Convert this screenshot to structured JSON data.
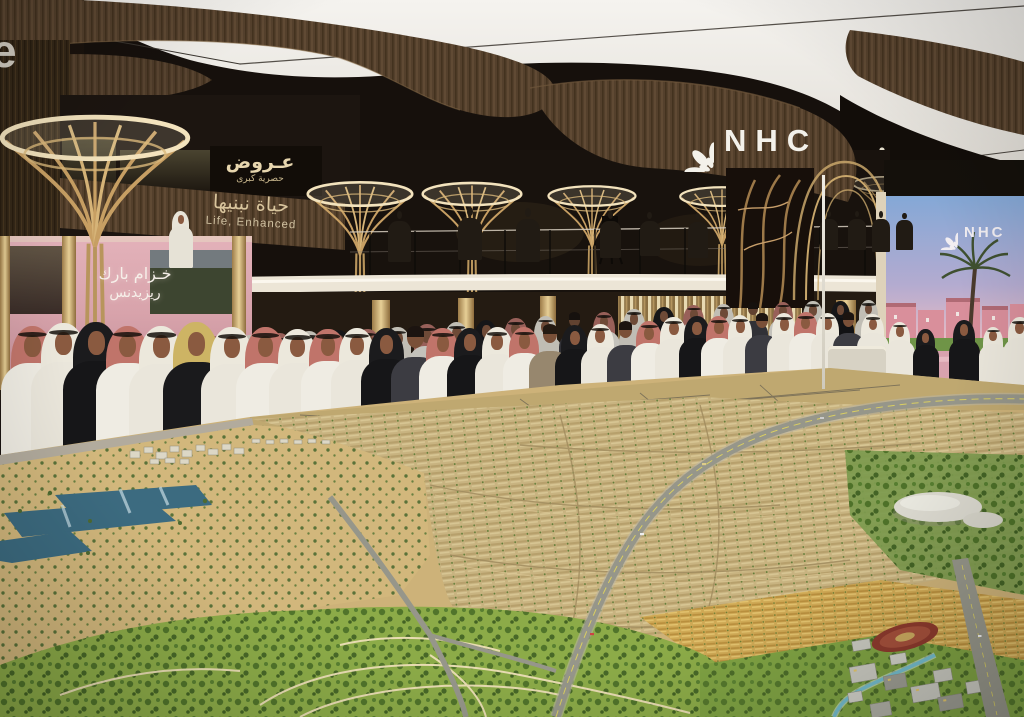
{
  "scene": {
    "description": "Crowded real-estate exhibition stand of NHC with visitors in Saudi traditional dress viewing a giant illuminated scale model of a desert city masterplan",
    "elements": [
      "white luminous ceiling with wavy wooden canopies",
      "golden palm-shaped light columns",
      "mezzanine with camera crews",
      "pink lit booth",
      "large LED screen with community render",
      "huge city masterplan model with desert, lakes, housing rows, park, highway and stadium"
    ]
  },
  "branding": {
    "logo_text": "NHC",
    "logo_mark": "leaf-rosette"
  },
  "signage": {
    "fascia_arabic": "حياة نبنيها",
    "fascia_english": "Life, Enhanced",
    "offers_line1": "عـروض",
    "offers_line2": "حصرية كبرى",
    "booth_arabic_line1": "خـزام بارك",
    "booth_arabic_line2": "ريزيدنس",
    "left_edge_partial": "e"
  },
  "led_screen": {
    "logo_text": "NHC",
    "content": "residential community render: blue-pink sky, pink villas, palm trees, green lawns, pink walkways"
  },
  "colors": {
    "ceilingWhite": "#f2f0ea",
    "wood": "#5a4430",
    "woodDark": "#2e2318",
    "gold": "#c9a76b",
    "glow": "#f7ead0",
    "pinkBooth": "#d8a3ab",
    "screenSky": "#84a8d6",
    "screenPink": "#e8c2c0",
    "screenBuilding": "#d98f9b",
    "sand": "#d2b77c",
    "modelBeige": "#c8b380",
    "parkGreen": "#8cab48",
    "treeGreen": "#4e7129",
    "water": "#3c6b80",
    "road": "#96968a",
    "laneYellow": "#d9ce62",
    "stadiumRed": "#8c3a2d",
    "whiteBldg": "#dbd9cf",
    "beamWhite": "#ece5d6"
  },
  "crowd": {
    "fields": [
      "x",
      "baseY",
      "h",
      "type",
      "backRow"
    ],
    "types": {
      "thobeRed": {
        "kind": "g",
        "drape": "#c0746a",
        "body": "#efece3",
        "agal": true
      },
      "thobeWhite": {
        "kind": "g",
        "drape": "#ece8dc",
        "body": "#eae6db",
        "agal": true
      },
      "abaya": {
        "kind": "g",
        "drape": "#1b1b1d",
        "body": "#161618",
        "agal": false
      },
      "abayaY": {
        "kind": "g",
        "drape": "#cdb464",
        "body": "#1a1a1c",
        "agal": false
      },
      "thobeWhiteS": {
        "kind": "g",
        "drape": "#e8e4d8",
        "body": "#e6e2d6",
        "agal": false
      },
      "casualDark": {
        "kind": "casual",
        "body": "#3c3c42",
        "hair": "#1c1410"
      },
      "casualTan": {
        "kind": "casual",
        "body": "#97876e",
        "hair": "#241a12"
      },
      "silhouette": {
        "kind": "sil",
        "body": "#211b14"
      }
    },
    "people": [
      [
        168,
        268,
        60,
        "thobeWhiteS",
        0
      ],
      [
        388,
        262,
        52,
        "silhouette",
        0
      ],
      [
        458,
        260,
        54,
        "silhouette",
        0
      ],
      [
        516,
        262,
        55,
        "silhouette",
        0
      ],
      [
        600,
        258,
        48,
        "silhouette",
        0
      ],
      [
        640,
        256,
        45,
        "silhouette",
        0
      ],
      [
        688,
        258,
        46,
        "silhouette",
        0
      ],
      [
        820,
        250,
        40,
        "silhouette",
        0
      ],
      [
        848,
        250,
        40,
        "silhouette",
        0
      ],
      [
        872,
        252,
        42,
        "silhouette",
        0
      ],
      [
        896,
        250,
        38,
        "silhouette",
        0
      ],
      [
        12,
        440,
        115,
        "thobeWhite",
        1
      ],
      [
        40,
        442,
        112,
        "thobeRed",
        1
      ],
      [
        70,
        444,
        110,
        "thobeWhite",
        1
      ],
      [
        100,
        440,
        108,
        "abaya",
        1
      ],
      [
        130,
        438,
        108,
        "thobeRed",
        1
      ],
      [
        160,
        440,
        110,
        "thobeWhite",
        1
      ],
      [
        195,
        436,
        105,
        "thobeRed",
        1
      ],
      [
        228,
        432,
        102,
        "thobeWhite",
        1
      ],
      [
        258,
        428,
        100,
        "thobeRed",
        1
      ],
      [
        288,
        424,
        98,
        "thobeWhite",
        1
      ],
      [
        318,
        420,
        95,
        "abaya",
        1
      ],
      [
        348,
        416,
        92,
        "thobeRed",
        1
      ],
      [
        378,
        412,
        90,
        "thobeWhite",
        1
      ],
      [
        408,
        408,
        88,
        "thobeRed",
        1
      ],
      [
        438,
        404,
        86,
        "thobeWhite",
        1
      ],
      [
        468,
        400,
        84,
        "abaya",
        1
      ],
      [
        498,
        396,
        82,
        "thobeRed",
        1
      ],
      [
        528,
        392,
        80,
        "thobeWhite",
        1
      ],
      [
        558,
        388,
        78,
        "casualDark",
        1
      ],
      [
        588,
        384,
        76,
        "thobeRed",
        1
      ],
      [
        618,
        380,
        75,
        "thobeWhite",
        1
      ],
      [
        648,
        377,
        74,
        "abaya",
        1
      ],
      [
        678,
        374,
        73,
        "thobeRed",
        1
      ],
      [
        708,
        372,
        72,
        "thobeWhite",
        1
      ],
      [
        738,
        370,
        70,
        "casualDark",
        1
      ],
      [
        768,
        368,
        70,
        "thobeRed",
        1
      ],
      [
        798,
        366,
        68,
        "thobeWhite",
        1
      ],
      [
        826,
        364,
        66,
        "abaya",
        1
      ],
      [
        854,
        363,
        66,
        "thobeWhite",
        1
      ],
      [
        0,
        468,
        150,
        "thobeRed",
        0
      ],
      [
        30,
        470,
        155,
        "thobeWhite",
        0
      ],
      [
        62,
        472,
        158,
        "abaya",
        0
      ],
      [
        95,
        468,
        150,
        "thobeRed",
        0
      ],
      [
        128,
        470,
        152,
        "thobeWhite",
        0
      ],
      [
        162,
        474,
        160,
        "abayaY",
        0
      ],
      [
        200,
        468,
        148,
        "thobeWhite",
        0
      ],
      [
        235,
        462,
        142,
        "thobeRed",
        0
      ],
      [
        268,
        458,
        136,
        "thobeWhite",
        0
      ],
      [
        300,
        452,
        130,
        "thobeRed",
        0
      ],
      [
        330,
        448,
        126,
        "thobeWhite",
        0
      ],
      [
        360,
        444,
        122,
        "abaya",
        0
      ],
      [
        390,
        440,
        118,
        "casualDark",
        0
      ],
      [
        418,
        436,
        114,
        "thobeRed",
        0
      ],
      [
        446,
        432,
        110,
        "abaya",
        0
      ],
      [
        474,
        428,
        106,
        "thobeWhite",
        0
      ],
      [
        502,
        424,
        102,
        "thobeRed",
        0
      ],
      [
        528,
        420,
        99,
        "casualTan",
        0
      ],
      [
        554,
        416,
        96,
        "abaya",
        0
      ],
      [
        580,
        412,
        93,
        "thobeWhite",
        0
      ],
      [
        606,
        408,
        90,
        "casualDark",
        0
      ],
      [
        630,
        405,
        88,
        "thobeRed",
        0
      ],
      [
        654,
        402,
        90,
        "thobeWhite",
        0
      ],
      [
        678,
        400,
        88,
        "abaya",
        0
      ],
      [
        700,
        398,
        86,
        "thobeRed",
        0
      ],
      [
        722,
        396,
        85,
        "thobeWhite",
        0
      ],
      [
        744,
        394,
        84,
        "casualDark",
        0
      ],
      [
        766,
        392,
        83,
        "thobeWhite",
        0
      ],
      [
        788,
        390,
        82,
        "thobeRed",
        0
      ],
      [
        810,
        389,
        80,
        "thobeWhite",
        0
      ],
      [
        832,
        388,
        78,
        "casualDark",
        0
      ],
      [
        856,
        388,
        78,
        "thobeWhite",
        0
      ],
      [
        884,
        390,
        72,
        "thobeWhite",
        0
      ],
      [
        912,
        390,
        64,
        "abaya",
        0
      ],
      [
        948,
        392,
        76,
        "abaya",
        0
      ],
      [
        978,
        393,
        70,
        "thobeWhite",
        0
      ],
      [
        1002,
        395,
        82,
        "thobeWhite",
        0
      ]
    ]
  }
}
